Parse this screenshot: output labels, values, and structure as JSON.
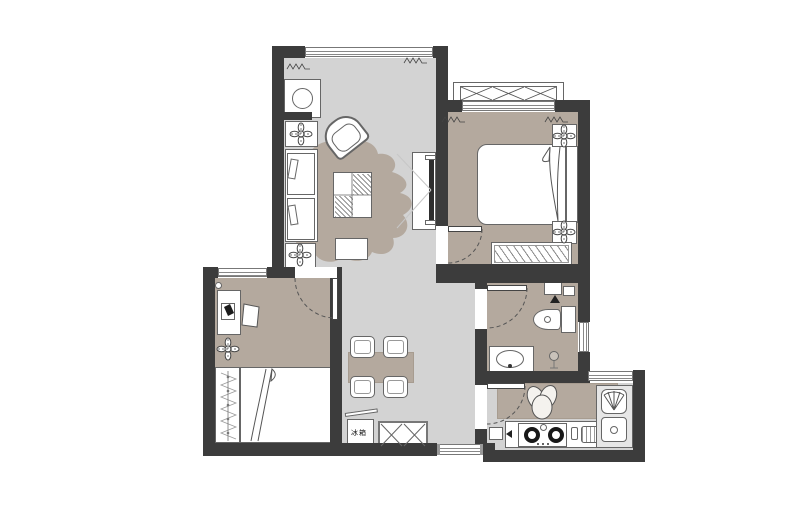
{
  "scene": {
    "type": "apartment-floor-plan",
    "view": "top-down architectural drawing"
  },
  "colors": {
    "wall": "#3c3c3c",
    "floor_light": "#d3d3d3",
    "floor_taupe": "#b4a99e",
    "line": "#666666",
    "fill_white": "#ffffff",
    "tv_screen": "#2e2e2e"
  },
  "labels": {
    "fridge": "冰箱"
  },
  "rooms": [
    {
      "id": "living-room",
      "items": [
        "washing-machine",
        "plant-side-table-top",
        "sofa",
        "armchair",
        "coffee-table",
        "side-tray",
        "area-rug",
        "wall-tv"
      ]
    },
    {
      "id": "dining-area",
      "items": [
        "dining-table",
        "dining-chairs-x4",
        "refrigerator",
        "shoe-cabinet"
      ]
    },
    {
      "id": "master-bedroom",
      "items": [
        "bay-window",
        "double-bed",
        "nightstand-x2",
        "headboard",
        "wardrobe"
      ]
    },
    {
      "id": "second-bedroom",
      "items": [
        "desk",
        "desk-chair",
        "laptop",
        "plant",
        "wardrobe",
        "double-bed"
      ]
    },
    {
      "id": "bathroom",
      "items": [
        "toilet",
        "vanity-sink",
        "floor-drain",
        "shelf"
      ]
    },
    {
      "id": "kitchen",
      "items": [
        "counter",
        "potted-plant",
        "gas-stove",
        "sink-unit",
        "dish-rack",
        "bottle"
      ]
    }
  ]
}
